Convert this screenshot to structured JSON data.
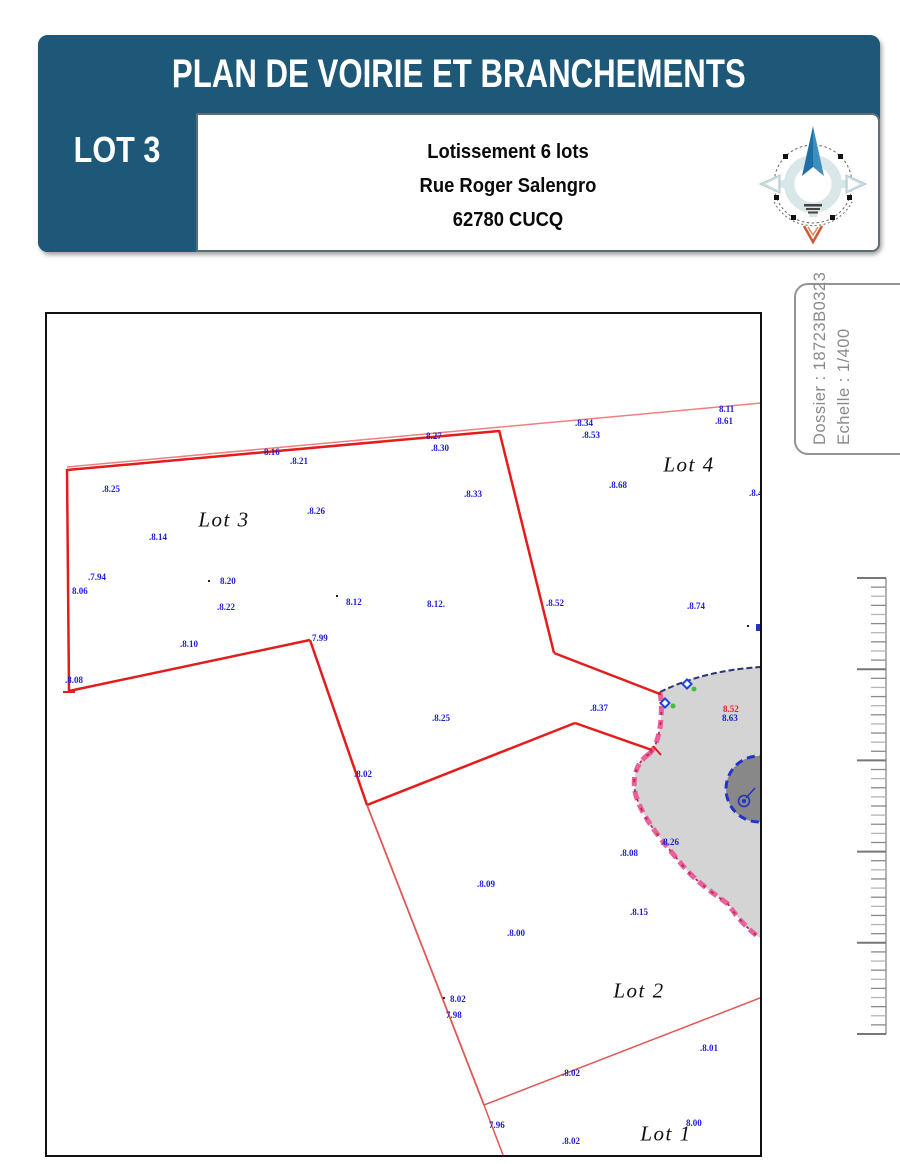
{
  "header": {
    "title": "PLAN DE VOIRIE ET BRANCHEMENTS",
    "lot_label": "LOT 3",
    "address_lines": [
      "Lotissement 6 lots",
      "Rue Roger Salengro",
      "62780 CUCQ"
    ]
  },
  "side_panel": {
    "dossier": "Dossier : 18723B0323",
    "echelle": "Echelle : 1/400"
  },
  "colors": {
    "header_blue": "#1e5878",
    "red": "#e31c1c",
    "mid_red": "#e05858",
    "light_red": "#ef8080",
    "label_blue": "#1c1cd6",
    "road_gray": "#d4d4d4",
    "island_gray": "#888888",
    "edge_pink": "#ec5f9e",
    "edge_dark_red": "#b03050",
    "dash_blue": "#2233cc",
    "green": "#3fbf3f",
    "ruler_gray": "#8a8a8a"
  },
  "plan": {
    "lots": [
      {
        "t": "Lot 3",
        "x": 177,
        "y": 206
      },
      {
        "t": "Lot 4",
        "x": 642,
        "y": 151
      },
      {
        "t": "Lot 2",
        "x": 592,
        "y": 677
      },
      {
        "t": "Lot 1",
        "x": 619,
        "y": 820
      }
    ],
    "elevations": [
      {
        "t": "8.11",
        "x": 672,
        "y": 91
      },
      {
        "t": ".8.61",
        "x": 668,
        "y": 103
      },
      {
        "t": ".8.34",
        "x": 528,
        "y": 105
      },
      {
        "t": ".8.53",
        "x": 535,
        "y": 117
      },
      {
        "t": "8.27",
        "x": 379,
        "y": 118
      },
      {
        "t": ".8.30",
        "x": 384,
        "y": 130
      },
      {
        "t": "8.16",
        "x": 217,
        "y": 134
      },
      {
        "t": ".8.21",
        "x": 243,
        "y": 143
      },
      {
        "t": ".8.25",
        "x": 55,
        "y": 171
      },
      {
        "t": ".8.33",
        "x": 417,
        "y": 176
      },
      {
        "t": ".8.68",
        "x": 562,
        "y": 167
      },
      {
        "t": ".8.46",
        "x": 702,
        "y": 175
      },
      {
        "t": ".8.26",
        "x": 260,
        "y": 193
      },
      {
        "t": ".8.14",
        "x": 102,
        "y": 219
      },
      {
        "t": ".7.94",
        "x": 41,
        "y": 259
      },
      {
        "t": "8.06",
        "x": 25,
        "y": 273
      },
      {
        "t": "8.20",
        "x": 173,
        "y": 263
      },
      {
        "t": ".8.22",
        "x": 170,
        "y": 289
      },
      {
        "t": "8.12",
        "x": 299,
        "y": 284
      },
      {
        "t": "8.12.",
        "x": 380,
        "y": 286
      },
      {
        "t": ".8.52",
        "x": 499,
        "y": 285
      },
      {
        "t": ".8.74",
        "x": 640,
        "y": 288
      },
      {
        "t": ".8.10",
        "x": 133,
        "y": 326
      },
      {
        "t": "7.99",
        "x": 265,
        "y": 320
      },
      {
        "t": ".8.08",
        "x": 18,
        "y": 362
      },
      {
        "t": ".8.37",
        "x": 543,
        "y": 390
      },
      {
        "t": ".8.25",
        "x": 385,
        "y": 400
      },
      {
        "t": ".8.02",
        "x": 307,
        "y": 456
      },
      {
        "t": "8.52",
        "x": 676,
        "y": 391,
        "c": "red"
      },
      {
        "t": "8.63",
        "x": 675,
        "y": 400
      },
      {
        "t": ".8.26",
        "x": 614,
        "y": 524
      },
      {
        "t": ".8.08",
        "x": 573,
        "y": 535
      },
      {
        "t": ".8.09",
        "x": 430,
        "y": 566
      },
      {
        "t": ".8.15",
        "x": 583,
        "y": 594
      },
      {
        "t": ".8.00",
        "x": 460,
        "y": 615
      },
      {
        "t": "8.02",
        "x": 403,
        "y": 681
      },
      {
        "t": "7.98",
        "x": 399,
        "y": 697
      },
      {
        "t": ".8.01",
        "x": 653,
        "y": 730
      },
      {
        "t": ".8.02",
        "x": 515,
        "y": 755
      },
      {
        "t": "7.96",
        "x": 442,
        "y": 807
      },
      {
        "t": ".8.02",
        "x": 515,
        "y": 823
      },
      {
        "t": "8.00",
        "x": 639,
        "y": 805
      }
    ],
    "points": [
      [
        161,
        266
      ],
      [
        289,
        281
      ],
      [
        396,
        683
      ],
      [
        700,
        311
      ]
    ],
    "geometry": {
      "view": [
        713,
        841
      ],
      "lines": [
        {
          "pts": [
            [
              20,
              153
            ],
            [
              715,
              89
            ]
          ],
          "w": 1.5,
          "c": "light_red"
        },
        {
          "pts": [
            [
              20,
              156
            ],
            [
              452,
              117
            ]
          ],
          "w": 2.5,
          "c": "red"
        },
        {
          "pts": [
            [
              452,
              116
            ],
            [
              507,
              339
            ]
          ],
          "w": 2.5,
          "c": "red"
        },
        {
          "pts": [
            [
              507,
              339
            ],
            [
              613,
              380
            ]
          ],
          "w": 2.5,
          "c": "red"
        },
        {
          "pts": [
            [
              20,
              155
            ],
            [
              22,
              377
            ]
          ],
          "w": 2.5,
          "c": "red"
        },
        {
          "pts": [
            [
              16,
              378
            ],
            [
              28,
              378
            ]
          ],
          "w": 2,
          "c": "red"
        },
        {
          "pts": [
            [
              22,
              377
            ],
            [
              263,
              326
            ]
          ],
          "w": 2.5,
          "c": "red"
        },
        {
          "pts": [
            [
              263,
              326
            ],
            [
              320,
              491
            ]
          ],
          "w": 2.5,
          "c": "red"
        },
        {
          "pts": [
            [
              320,
              491
            ],
            [
              528,
              409
            ]
          ],
          "w": 2.5,
          "c": "red"
        },
        {
          "pts": [
            [
              528,
              409
            ],
            [
              605,
              436
            ]
          ],
          "w": 2.5,
          "c": "red"
        },
        {
          "pts": [
            [
              320,
              491
            ],
            [
              437,
              791
            ]
          ],
          "w": 1.8,
          "c": "mid_red"
        },
        {
          "pts": [
            [
              437,
              791
            ],
            [
              713,
              684
            ]
          ],
          "w": 1.5,
          "c": "mid_red"
        },
        {
          "pts": [
            [
              437,
              791
            ],
            [
              456,
              841
            ]
          ],
          "w": 1.5,
          "c": "mid_red"
        }
      ],
      "road_fill": "M 613,378 C 650,360 685,355 713,353 L 713,624 C 702,616 692,606 681,590 C 663,577 650,568 636,552 C 618,530 597,507 589,482 C 584,463 590,448 602,440 C 612,432 617,402 613,378 Z",
      "pink_edge": "M 602,440 C 590,448 584,463 589,482 C 597,507 618,530 636,552 C 650,568 663,577 681,590 C 692,606 702,616 713,624",
      "throat_edge": "M 613,378 C 617,402 612,432 602,440",
      "blue_edge": "M 613,378 C 650,360 685,355 713,353",
      "island": {
        "cx": 712,
        "cy": 475,
        "r": 33
      },
      "lamp": {
        "cx": 697,
        "cy": 487,
        "r": 5.5,
        "tip": [
          708,
          474
        ]
      },
      "diamonds": [
        [
          640,
          370
        ],
        [
          618,
          389
        ]
      ],
      "green_dots": [
        [
          647,
          375
        ],
        [
          626,
          392
        ]
      ],
      "red_tick": [
        [
          606,
          432
        ],
        [
          614,
          441
        ]
      ],
      "clip_mark": [
        709,
        310
      ]
    }
  },
  "ruler": {
    "height": 456,
    "majors": 6,
    "minors_per_interval": 9
  }
}
